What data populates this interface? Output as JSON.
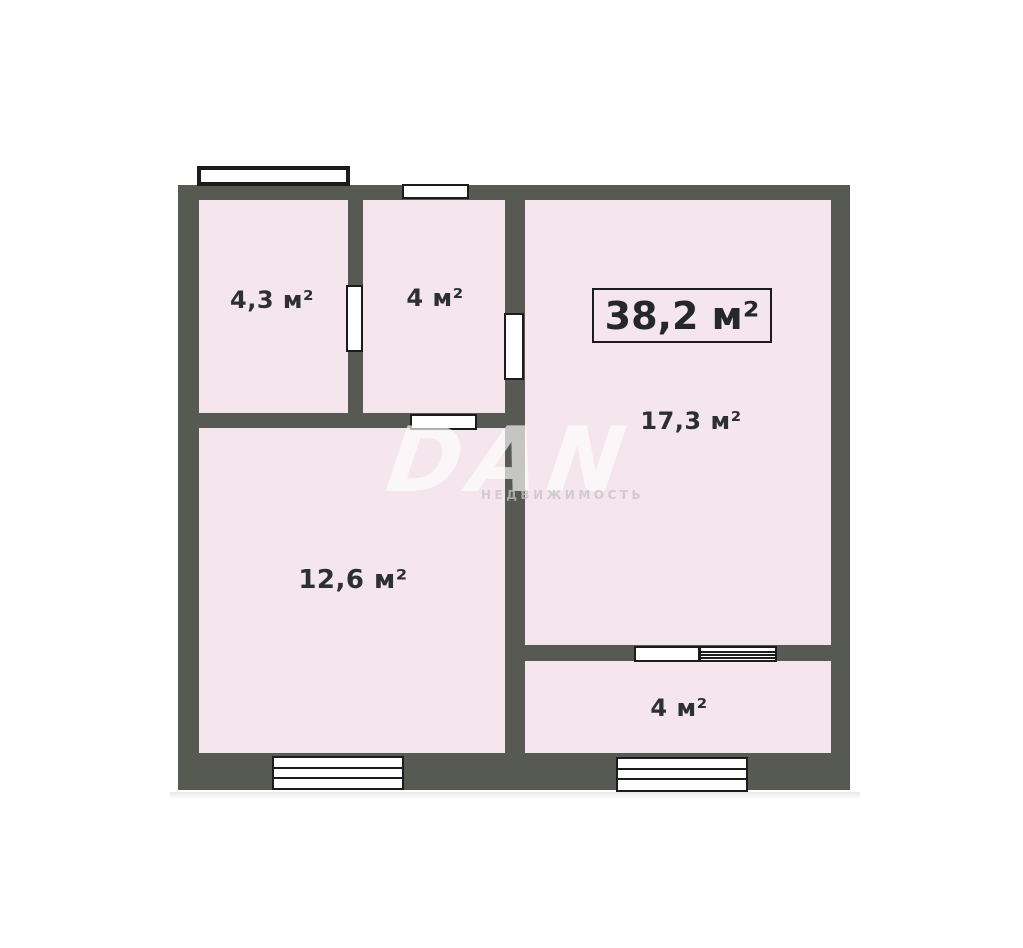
{
  "plan": {
    "total_area": {
      "label": "38,2 м²",
      "value_m2": 38.2
    },
    "rooms": [
      {
        "id": "dressing",
        "label": "4,3 м²",
        "value_m2": 4.3
      },
      {
        "id": "hall",
        "label": "4 м²",
        "value_m2": 4
      },
      {
        "id": "living",
        "label": "17,3 м²",
        "value_m2": 17.3
      },
      {
        "id": "kitchen",
        "label": "12,6 м²",
        "value_m2": 12.6
      },
      {
        "id": "balcony",
        "label": "4 м²",
        "value_m2": 4
      }
    ],
    "watermark": {
      "logo": "DAN",
      "subtitle": "НЕДВИЖИМОСТЬ"
    },
    "colors": {
      "wall": "#565a52",
      "room_fill": "#f4e6ec",
      "opening_outline": "#1c1c1c",
      "label_text": "#2d3032",
      "background": "#ffffff"
    }
  }
}
